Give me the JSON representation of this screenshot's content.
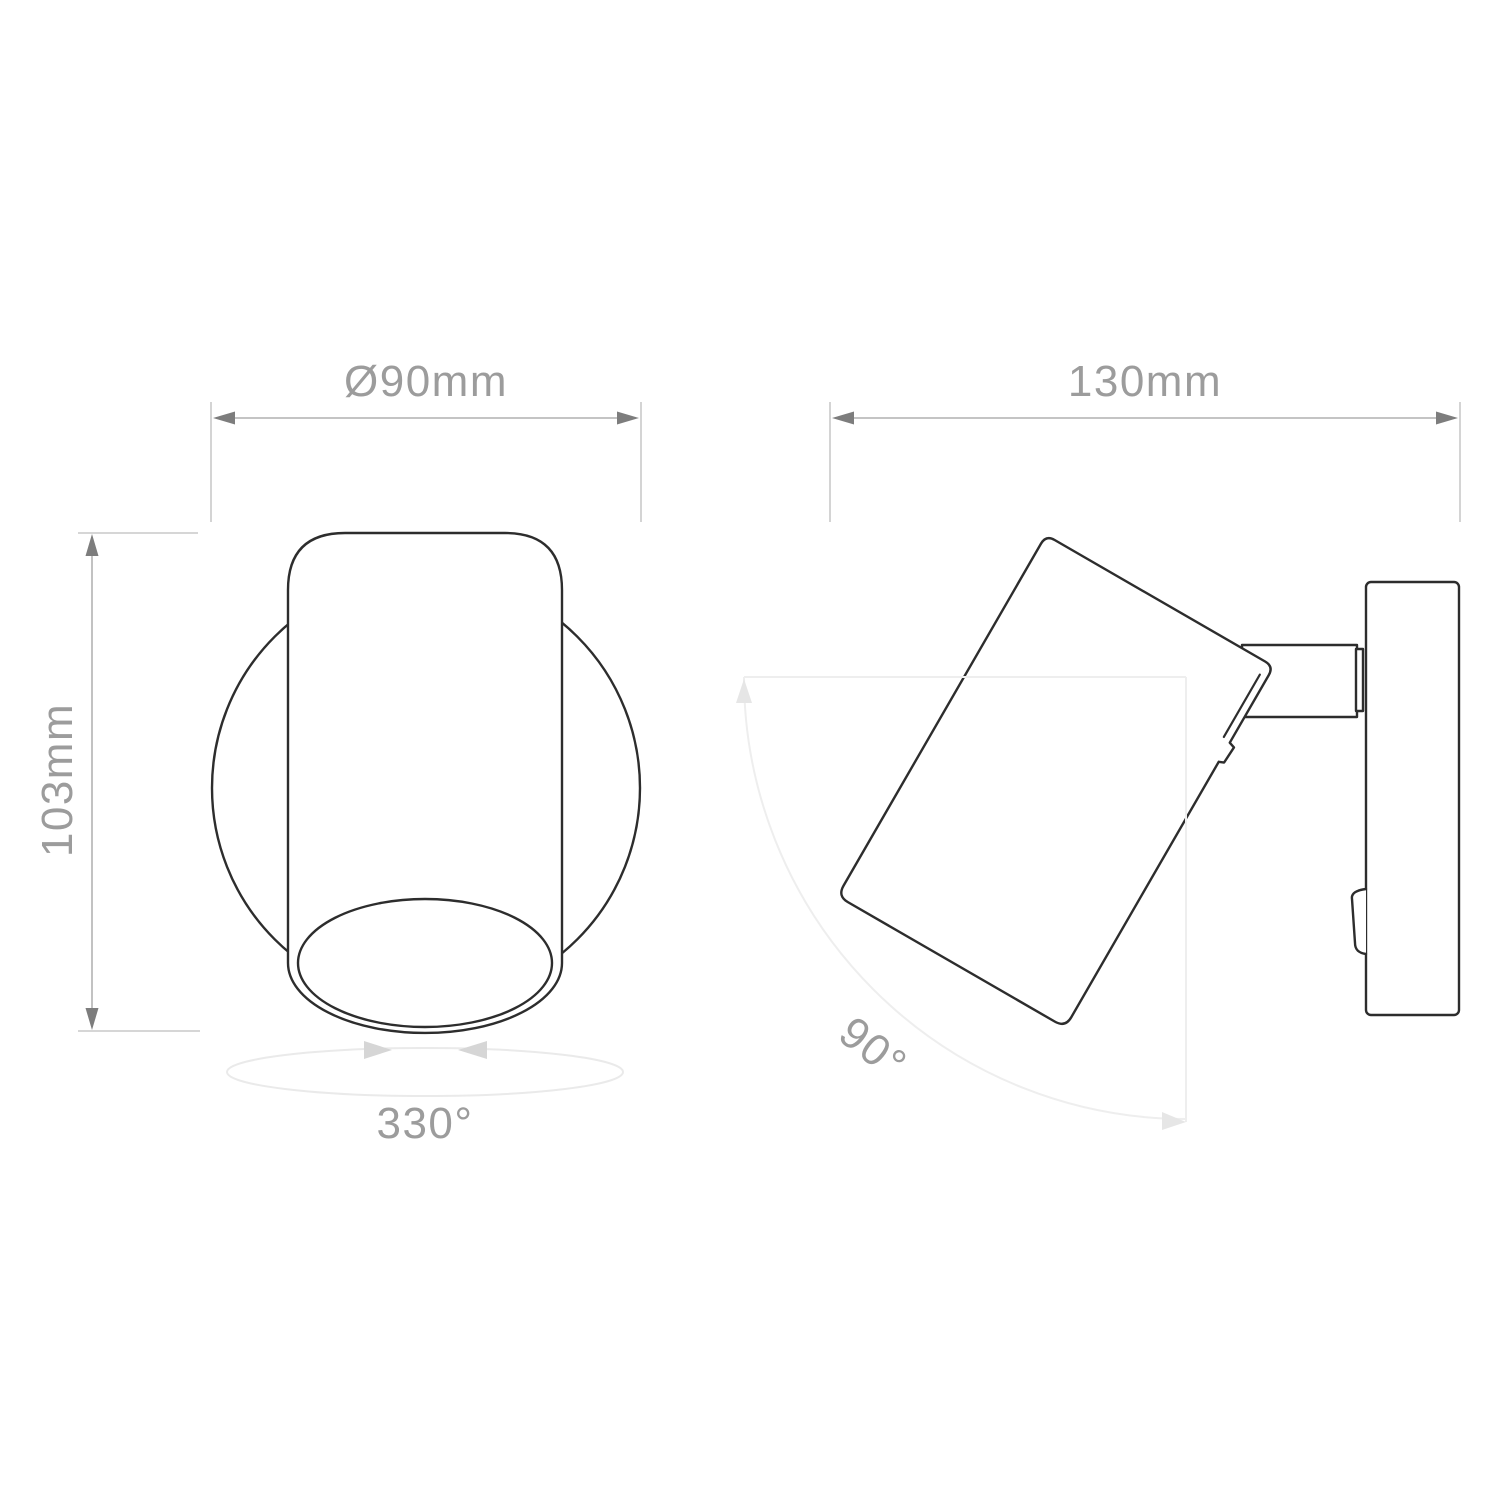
{
  "page": {
    "background": "#ffffff",
    "type": "technical dimension drawing",
    "subject": "adjustable wall spotlight, front and side views"
  },
  "front_view": {
    "diameter_dimension": "Ø90mm",
    "height_dimension": "103mm",
    "rotation_range": "330°"
  },
  "side_view": {
    "width_dimension": "130mm",
    "tilt_range": "90°"
  },
  "colors": {
    "outline": "#2d2d2d",
    "dimension_line": "#bcbcbc",
    "dimension_arrow": "#7d7d7d",
    "label_text": "#9c9c9c",
    "ghost_line": "#eeeeee",
    "ghost_arrow": "#e6e6e6",
    "rotation_ellipse": "#eaeaea",
    "rotation_arrow": "#d6d6d6"
  }
}
